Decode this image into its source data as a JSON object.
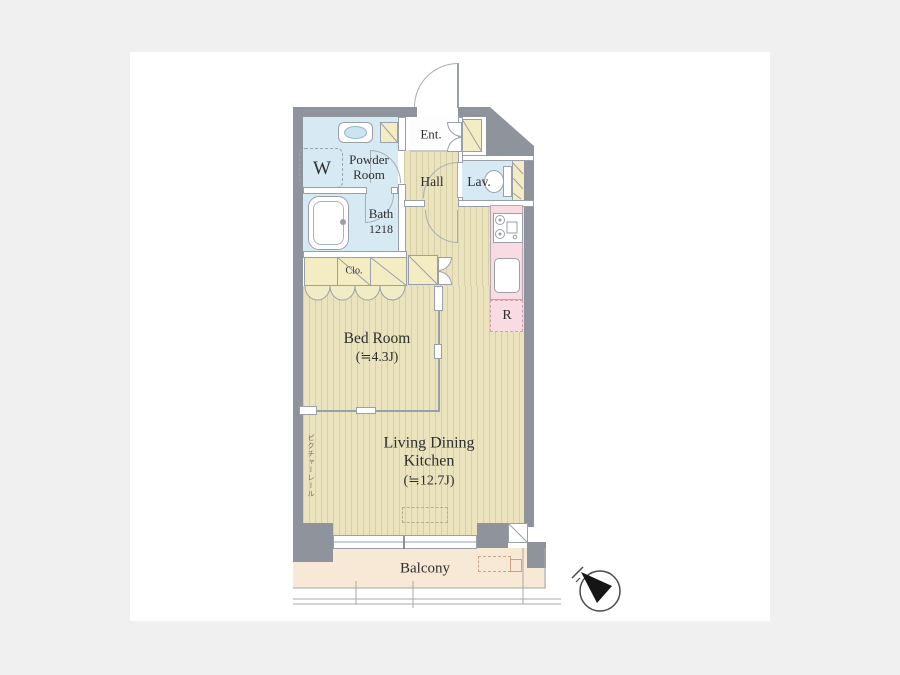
{
  "title": "Apartment floor plan",
  "colors": {
    "page_background": "#f0f0f0",
    "canvas_background": "#ffffff",
    "outer_wall": "#8f939b",
    "floor_base": "#eae3bd",
    "floor_stripe": "#d7d0a7",
    "wet_area_blue": "#d7e9f3",
    "closet_yellow": "#f4edc4",
    "kitchen_pink": "#f9dbe3",
    "balcony_peach": "#f8e8d6"
  },
  "rooms": {
    "entrance": "Ent.",
    "hall": "Hall",
    "powder_line1": "Powder",
    "powder_line2": "Room",
    "washer": "W",
    "bath": "Bath",
    "bath_size": "1218",
    "lavatory": "Lav.",
    "closet": "Clo.",
    "bedroom": "Bed Room",
    "bedroom_area": "(≒4.3J)",
    "ldk_line1": "Living Dining",
    "ldk_line2": "Kitchen",
    "ldk_area": "(≒12.7J)",
    "balcony": "Balcony",
    "refrigerator": "R",
    "picture_rail": "ピクチャーレール"
  },
  "icons": {
    "compass": "compass-north-needle",
    "bathtub": "bathtub-icon",
    "washbasin": "washbasin-icon",
    "toilet": "toilet-icon",
    "stove": "stove-icon",
    "sink": "sink-icon"
  }
}
